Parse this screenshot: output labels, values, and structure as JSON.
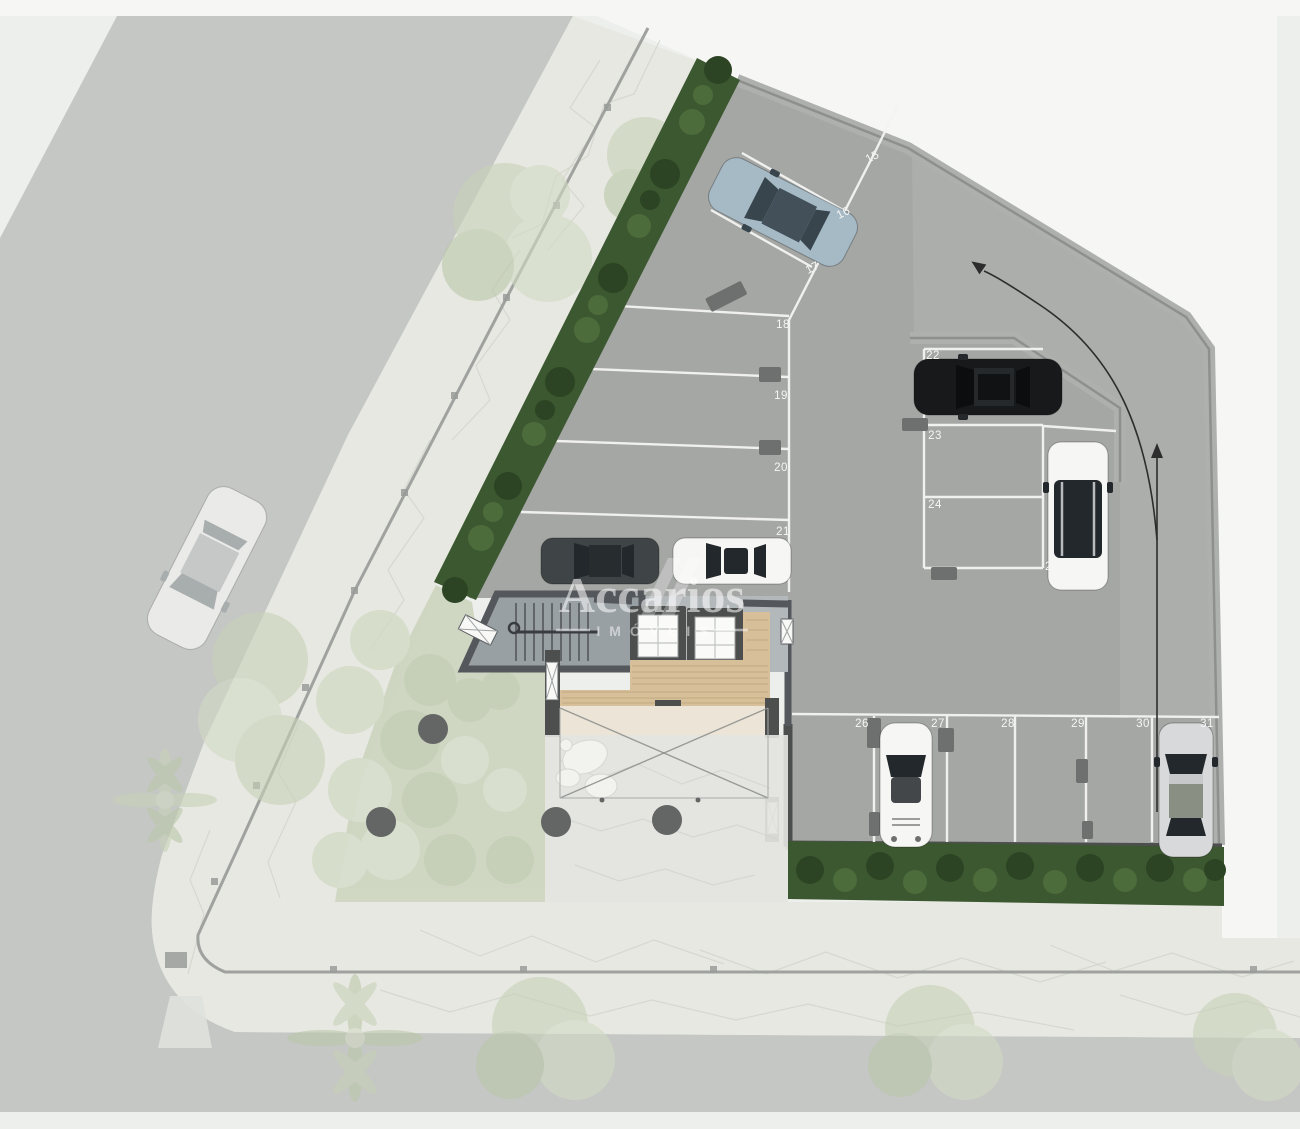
{
  "watermark": {
    "brand": "Accarios",
    "tagline": "IMÓVEIS"
  },
  "parking": {
    "spots": [
      "15",
      "16",
      "17",
      "18",
      "19",
      "20",
      "21",
      "22",
      "23",
      "24",
      "25",
      "26",
      "27",
      "28",
      "29",
      "30",
      "31"
    ],
    "groups": {
      "diagonal_top": [
        "15",
        "16",
        "17"
      ],
      "left_column": [
        "18",
        "19",
        "20",
        "21"
      ],
      "middle_block": [
        "22",
        "23",
        "24",
        "25"
      ],
      "bottom_row": [
        "26",
        "27",
        "28",
        "29",
        "30",
        "31"
      ]
    }
  },
  "scene": {
    "vehicles": [
      {
        "name": "street-white-car",
        "color": "#fbfbf9",
        "location": "left street"
      },
      {
        "name": "blue-gray-sedan",
        "color": "#a6bac6",
        "location": "spot 16"
      },
      {
        "name": "black-sedan",
        "color": "#17191b",
        "location": "spot 22"
      },
      {
        "name": "white-suv",
        "color": "#f1f1ef",
        "location": "spot 25"
      },
      {
        "name": "dark-gray-sedan",
        "color": "#3f4446",
        "location": "spot 21"
      },
      {
        "name": "white-coupe",
        "color": "#fafaf8",
        "location": "spot 21"
      },
      {
        "name": "white-sports-car",
        "color": "#f6f6f4",
        "location": "spot 27"
      },
      {
        "name": "silver-hatchback",
        "color": "#d7d9da",
        "location": "spot 31"
      }
    ],
    "landscape": [
      "dense-hedge-diagonal",
      "dense-hedge-bottom",
      "faded-garden",
      "street-trees",
      "palm-trees",
      "stone-sidewalk"
    ],
    "circulation": "drive-aisle-arrow entering bottom right, curving to top-left exit"
  },
  "theme": {
    "bg": "#edefec",
    "white_zone": "#f6f7f4",
    "road": "#b7b9b8",
    "stone": "#e7e8e2",
    "stone_line": "#d2d3cc",
    "fence": "#a0a29f",
    "hedge_dark": "#2c4423",
    "hedge_mid": "#3c5830",
    "hedge_light": "#4d6c3c",
    "garden_a": "#c6d0b6",
    "garden_b": "#d1dac4",
    "garden_c": "#b9c6a7",
    "slab": "#a5a7a5",
    "ramp": "#b2b4b2",
    "wall_light": "#aeb0ae",
    "wall_mid": "#8e908e",
    "wall_dark": "#4d4f4e",
    "line_white": "#f3f3f1",
    "label": "#f6f6f4",
    "core_floor": "#b3b8ba",
    "stair_floor": "#99a0a4",
    "core_wall": "#54575b",
    "wood": "#d7bf99",
    "wood_line": "#c2a981",
    "cream": "#ece5d7",
    "stone_court": "#e3e4df",
    "glass": "#23282c",
    "arrow": "#2d2d2d",
    "car_blue": "#a6bac6",
    "car_black": "#17191b",
    "car_white": "#f6f6f4",
    "car_silver": "#d7d9da",
    "watermark": "rgba(255,255,255,0.55)",
    "watermark_soft": "rgba(255,255,255,0.5)"
  }
}
